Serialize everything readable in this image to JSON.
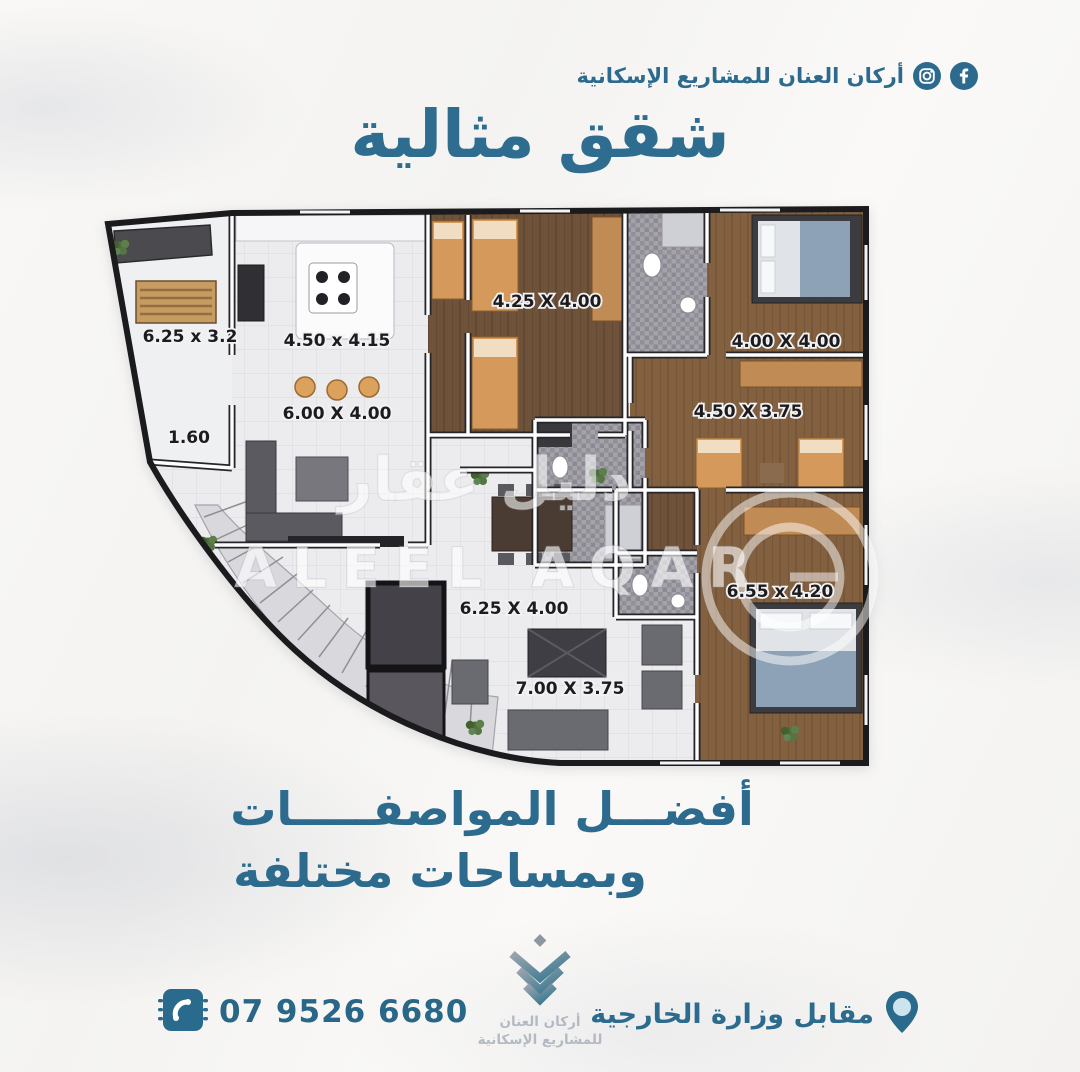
{
  "header": {
    "brand": "أركان العنان للمشاريع الإسكانية",
    "icons": [
      "instagram-icon",
      "facebook-icon"
    ]
  },
  "title": "شقق مثالية",
  "plan": {
    "dims": {
      "balcony": "6.25 x 3.2",
      "balcony_depth": "1.60",
      "kitchen": "4.50 x 4.15",
      "living": "6.00 X 4.00",
      "bedroom_top": "4.25 X 4.00",
      "bedroom_right_top": "4.00 X 4.00",
      "bedroom_right_mid": "4.50 X 3.75",
      "dining": "6.25 X 4.00",
      "bedroom_right_bottom": "6.55 x 4.20",
      "family": "7.00 X 3.75"
    },
    "watermark": {
      "arabic": "دليل عقار",
      "latin": "ALEEL AQAR"
    }
  },
  "tagline": {
    "line1": "أفضـــل المواصفـــــات",
    "line2": "وبمساحات مختلفة"
  },
  "footer": {
    "phone": "07 9526 6680",
    "location": "مقابل وزارة الخارجية",
    "logo_line1": "أركان العنان",
    "logo_line2": "للمشاريع الإسكانية"
  },
  "colors": {
    "accent": "#2d6b8e",
    "dimension_text": "#1c1c1f",
    "logo_text": "#b4bac3",
    "wood_floor": "#7c5c40",
    "bed_orange": "#d6995c"
  }
}
